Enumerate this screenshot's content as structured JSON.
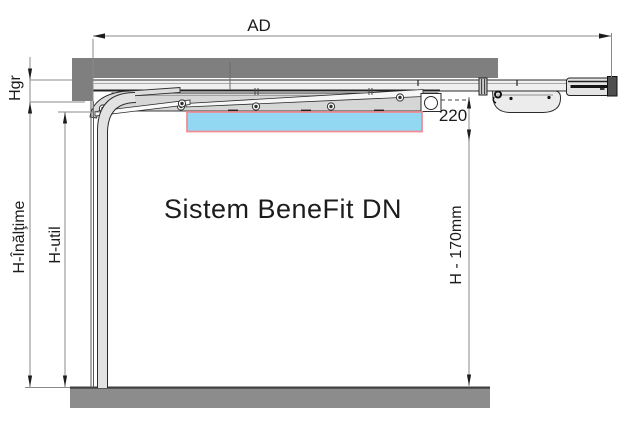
{
  "diagram": {
    "title": "Sistem BeneFit DN",
    "type": "sectional-garage-door-side-section",
    "labels": {
      "ad": "AD",
      "hgr": "Hgr",
      "height": "H-Înălţime",
      "usable_height": "H-util",
      "clearance_220": "220",
      "h_minus_170": "H - 170mm"
    },
    "colors": {
      "lintel_wall": "#7f7f7f",
      "floor": "#8c8c8c",
      "floor_edge": "#3f3f3f",
      "panel_highlight_fill": "#93d8f2",
      "panel_highlight_border": "#f08d97",
      "hardware_light": "#ececec",
      "hardware_mid": "#d6d6d6",
      "outline": "#2b2b2b",
      "dimension_line": "#8a8a8a",
      "arrow": "#1c1c1c"
    }
  }
}
